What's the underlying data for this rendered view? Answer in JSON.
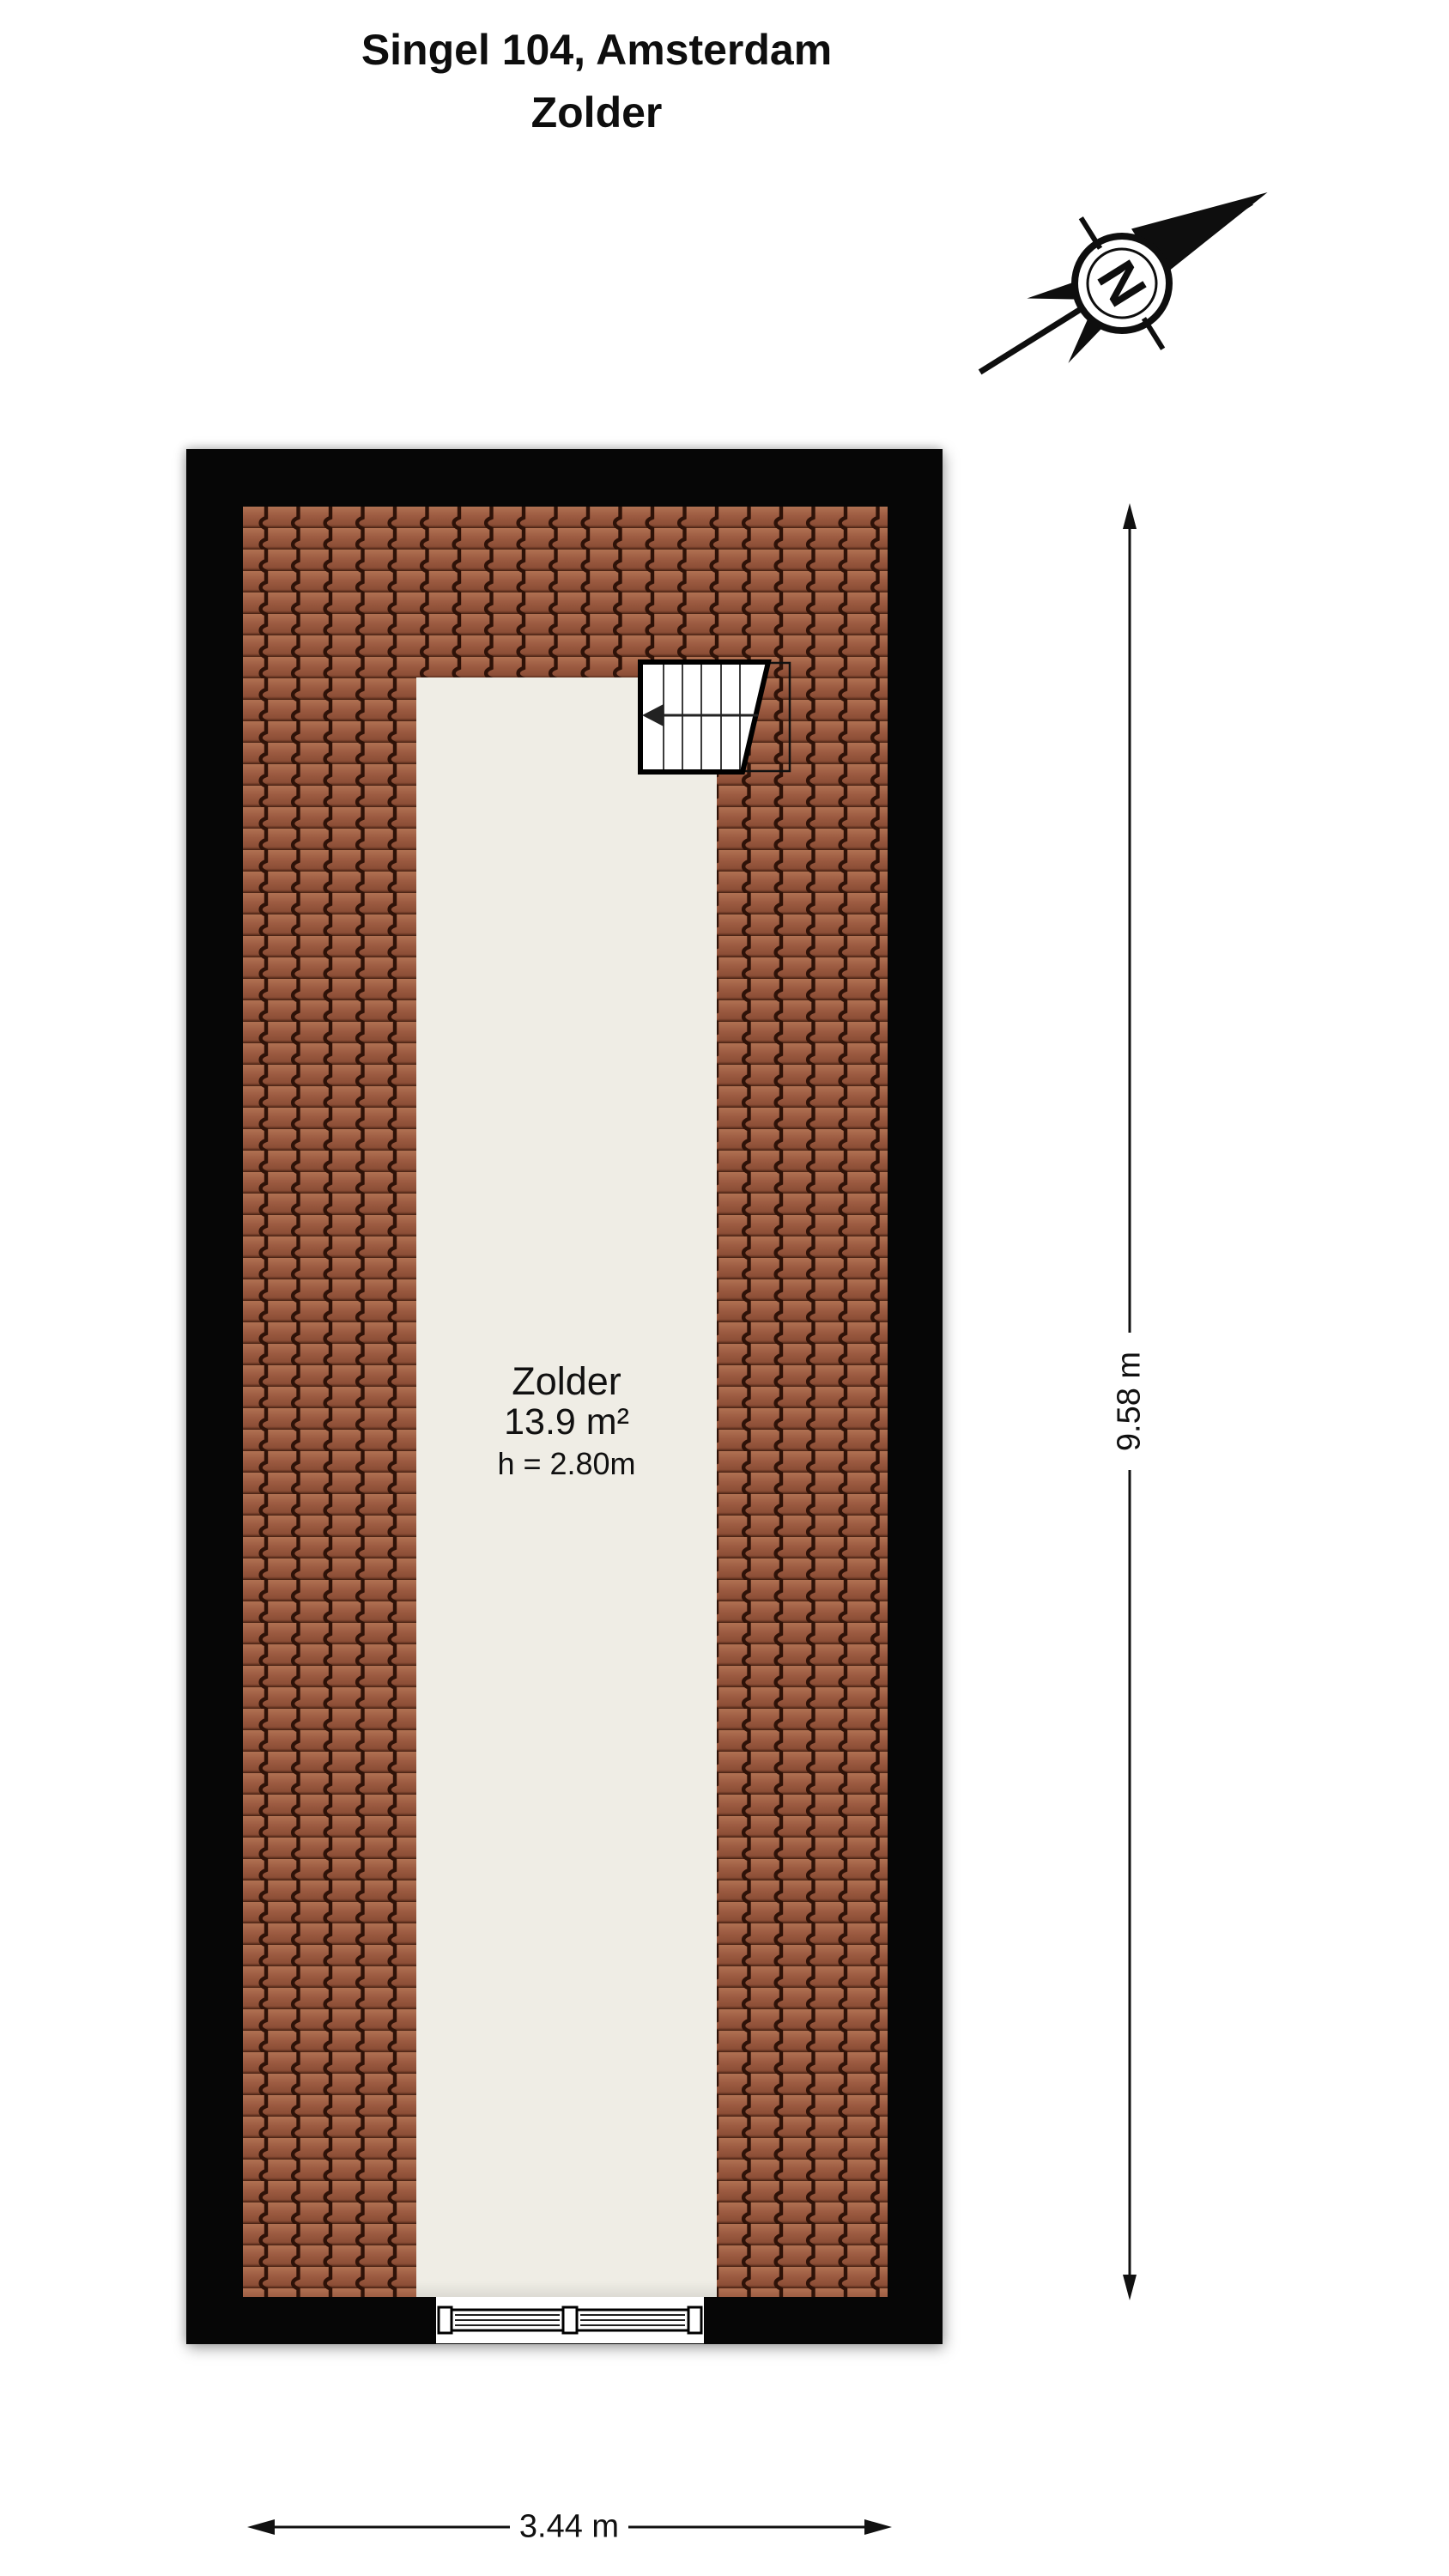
{
  "title": {
    "line1": "Singel 104, Amsterdam",
    "line2": "Zolder"
  },
  "compass": {
    "label": "N"
  },
  "room": {
    "name": "Zolder",
    "area": "13.9 m²",
    "ceiling_height": "h = 2.80m"
  },
  "dimensions": {
    "height": "9.58 m",
    "width": "3.44 m"
  },
  "colors": {
    "wall": "#060606",
    "floor": "#efede5",
    "roof_tile": "#9c5b41",
    "roof_tile_gap": "#2e1208"
  }
}
